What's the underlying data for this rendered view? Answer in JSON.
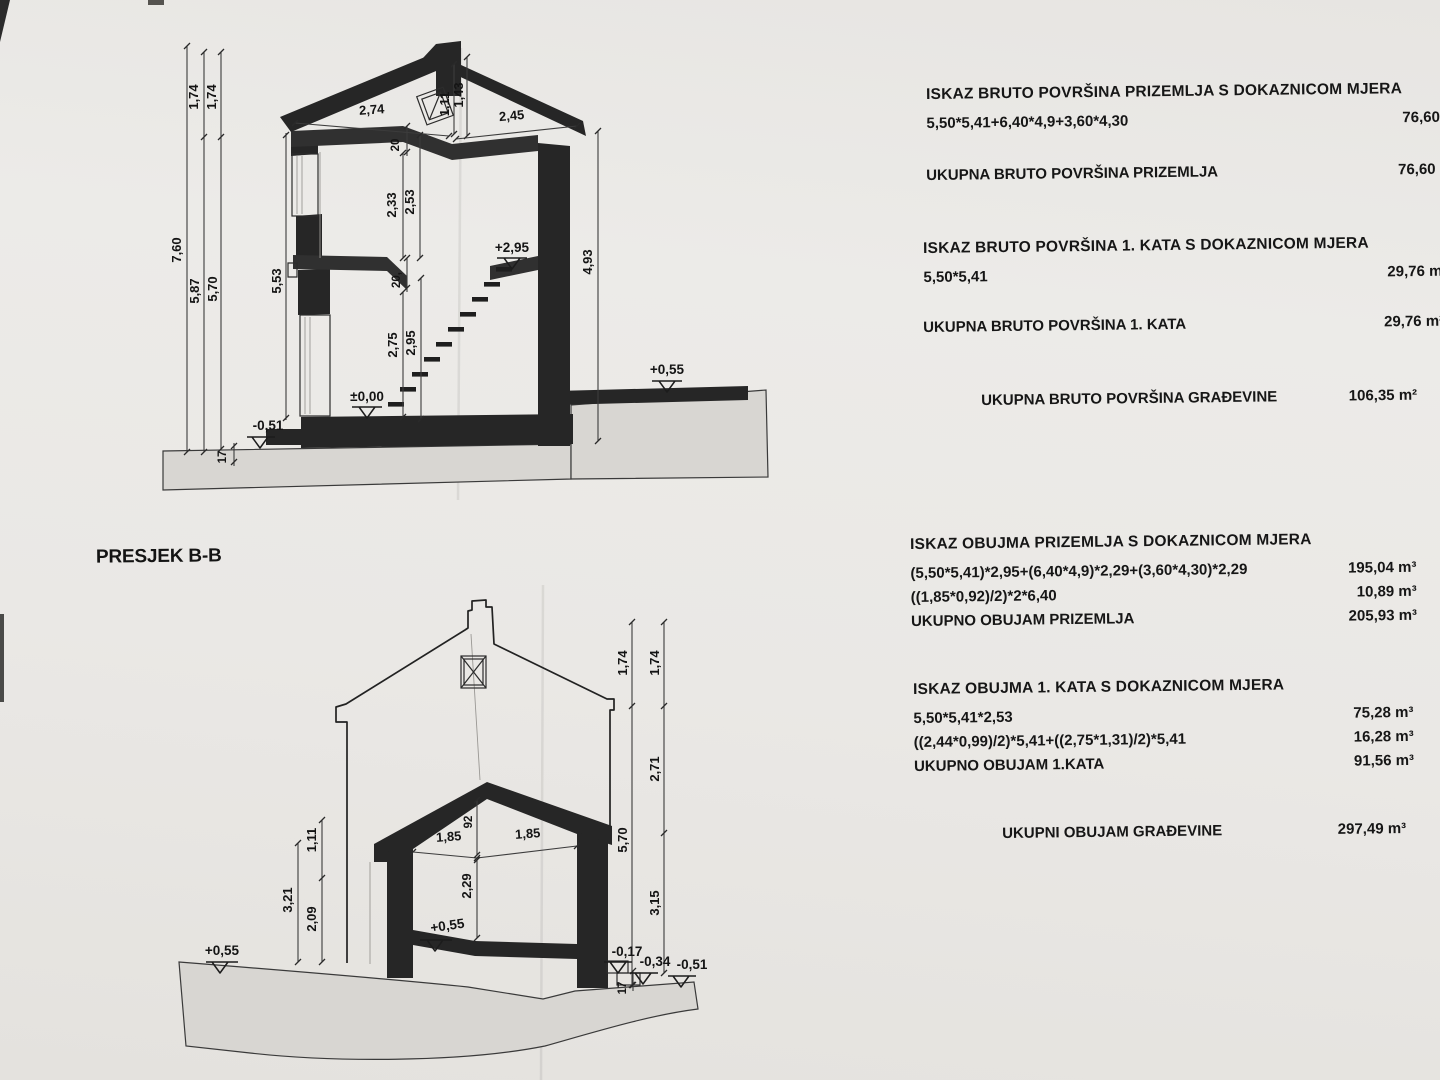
{
  "section_label": "PRESJEK B-B",
  "calc": {
    "b1": {
      "heading": "ISKAZ BRUTO POVRŠINA PRIZEMLJA S DOKAZNICOM MJERA",
      "rows": [
        {
          "f": "5,50*5,41+6,40*4,9+3,60*4,30",
          "v": "76,60 m²"
        }
      ]
    },
    "b2": {
      "rows": [
        {
          "f": "UKUPNA BRUTO POVRŠINA PRIZEMLJA",
          "v": "76,60 m²"
        }
      ]
    },
    "b3": {
      "heading": "ISKAZ BRUTO POVRŠINA 1. KATA S DOKAZNICOM MJERA",
      "rows": [
        {
          "f": "5,50*5,41",
          "v": "29,76 m²"
        }
      ]
    },
    "b4": {
      "rows": [
        {
          "f": "UKUPNA BRUTO POVRŠINA 1. KATA",
          "v": "29,76 m²"
        }
      ]
    },
    "b5": {
      "rows": [
        {
          "f": "UKUPNA BRUTO POVRŠINA GRAĐEVINE",
          "v": "106,35 m²"
        }
      ]
    },
    "b6": {
      "heading": "ISKAZ OBUJMA PRIZEMLJA S DOKAZNICOM MJERA",
      "rows": [
        {
          "f": "(5,50*5,41)*2,95+(6,40*4,9)*2,29+(3,60*4,30)*2,29",
          "v": "195,04 m³"
        },
        {
          "f": "((1,85*0,92)/2)*2*6,40",
          "v": "10,89 m³"
        },
        {
          "f": "UKUPNO OBUJAM PRIZEMLJA",
          "v": "205,93 m³"
        }
      ]
    },
    "b7": {
      "heading": "ISKAZ OBUJMA 1. KATA S DOKAZNICOM MJERA",
      "rows": [
        {
          "f": "5,50*5,41*2,53",
          "v": "75,28 m³"
        },
        {
          "f": "((2,44*0,99)/2)*5,41+((2,75*1,31)/2)*5,41",
          "v": "16,28 m³"
        },
        {
          "f": "UKUPNO OBUJAM 1.KATA",
          "v": "91,56 m³"
        }
      ]
    },
    "b8": {
      "rows": [
        {
          "f": "UKUPNI OBUJAM GRAĐEVINE",
          "v": "297,49 m³"
        }
      ]
    }
  },
  "top": {
    "d760": "7,60",
    "d174a": "1,74",
    "d174b": "1,74",
    "d587": "5,87",
    "d570": "5,70",
    "d553": "5,53",
    "d274": "2,74",
    "d245": "2,45",
    "d111": "1,11",
    "d143": "1,43",
    "d20a": "20",
    "d233": "2,33",
    "d253": "2,53",
    "d20b": "20,",
    "d275": "2,75",
    "d295": "2,95",
    "d493": "4,93",
    "d17": "17",
    "l295": "+2,95",
    "l000": "±0,00",
    "lm051": "-0,51",
    "l055": "+0,55"
  },
  "bottom": {
    "d174a": "1,74",
    "d174b": "1,74",
    "d271": "2,71",
    "d570": "5,70",
    "d315": "3,15",
    "d321": "3,21",
    "d209": "2,09",
    "d111": "1,11",
    "d185a": "1,85",
    "d185b": "1,85",
    "d92": "92",
    "d229": "2,29",
    "d17": "17",
    "l055a": "+0,55",
    "l055b": "+0,55",
    "lm017": "-0,17",
    "lm034": "-0,34",
    "lm051": "-0,51"
  }
}
